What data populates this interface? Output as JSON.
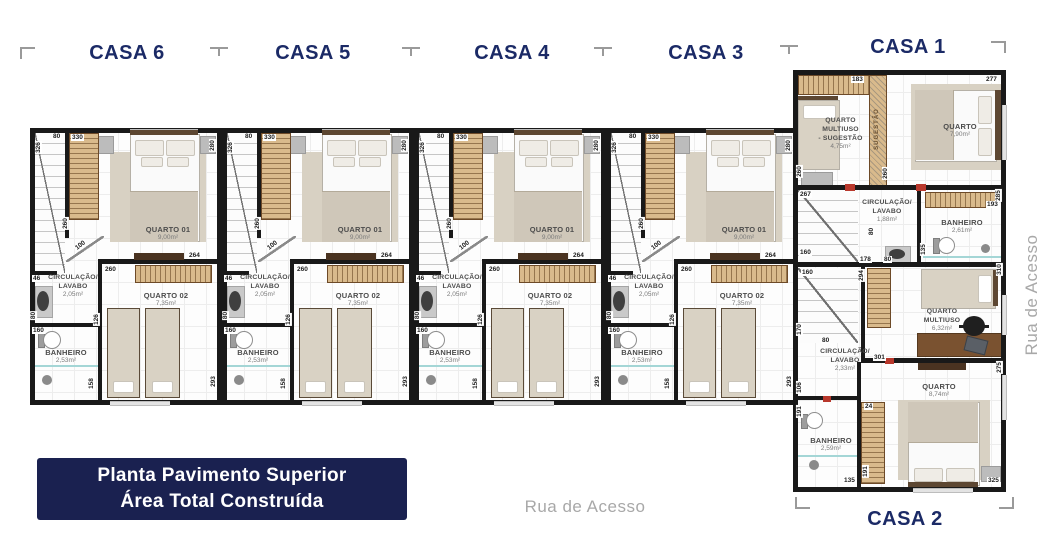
{
  "headers": {
    "casa6": "CASA 6",
    "casa5": "CASA 5",
    "casa4": "CASA 4",
    "casa3": "CASA 3",
    "casa1": "CASA 1",
    "casa2": "CASA 2"
  },
  "title_box": {
    "line1": "Planta Pavimento Superior",
    "line2": "Área Total Construída"
  },
  "streets": {
    "bottom": "Rua de Acesso",
    "right": "Rua de Acesso"
  },
  "colors": {
    "navy_text": "#1b2a66",
    "title_box_bg": "#1a2150",
    "wall": "#191919",
    "wood_closet": "#d9ba8c",
    "street_gray": "#a8a8a8"
  },
  "units": [
    "casa-6",
    "casa-5",
    "casa-4",
    "casa-3"
  ],
  "unit": {
    "rooms": {
      "quarto01": {
        "name": "QUARTO 01",
        "area": "9,00m²"
      },
      "circulacao": {
        "name1": "CIRCULAÇÃO/",
        "name2": "LAVABO",
        "area": "2,05m²"
      },
      "quarto02": {
        "name": "QUARTO 02",
        "area": "7,35m²"
      },
      "banheiro": {
        "name": "BANHEIRO",
        "area": "2,53m²"
      }
    },
    "dims": {
      "left326": "326",
      "top80": "80",
      "closet330": "330",
      "right280": "280",
      "closet260": "260",
      "door100": "100",
      "stub46": "46",
      "q1right264": "264",
      "q2closet260": "260",
      "div126": "126",
      "ban80": "80",
      "ban160": "160",
      "bottom158": "158",
      "right293": "293"
    }
  },
  "casa1": {
    "rooms": {
      "multiuso": {
        "name1": "QUARTO",
        "name2": "MULTIUSO",
        "name3": "- SUGESTÃO",
        "area": "4,75m²"
      },
      "sugestao_closet": "SUGESTÃO",
      "quarto": {
        "name": "QUARTO",
        "area": "7,90m²"
      },
      "circulacao": {
        "name1": "CIRCULAÇÃO/",
        "name2": "LAVABO",
        "area": "1,88m²"
      },
      "banheiro": {
        "name": "BANHEIRO",
        "area": "2,61m²"
      }
    },
    "dims": {
      "closet183": "183",
      "top277": "277",
      "left260": "260",
      "left267": "267",
      "mid260": "260",
      "right285": "285",
      "right193": "193",
      "left160": "160",
      "bot178": "178",
      "bot80": "80",
      "mid80": "80",
      "mid135": "135"
    }
  },
  "casa2": {
    "rooms": {
      "multiuso": {
        "name1": "QUARTO",
        "name2": "MULTIUSO",
        "area": "6,32m²"
      },
      "circulacao": {
        "name1": "CIRCULAÇÃO/",
        "name2": "LAVABO",
        "area": "2,33m²"
      },
      "quarto": {
        "name": "QUARTO",
        "area": "8,74m²"
      },
      "banheiro": {
        "name": "BANHEIRO",
        "area": "2,59m²"
      }
    },
    "dims": {
      "top160": "160",
      "stair294": "294",
      "right310": "310",
      "left170": "170",
      "circ80": "80",
      "circ301": "301",
      "right275": "275",
      "left106": "106",
      "left191": "191",
      "closet24": "24",
      "closet191": "191",
      "bottom135": "135",
      "bottom325": "325"
    }
  }
}
